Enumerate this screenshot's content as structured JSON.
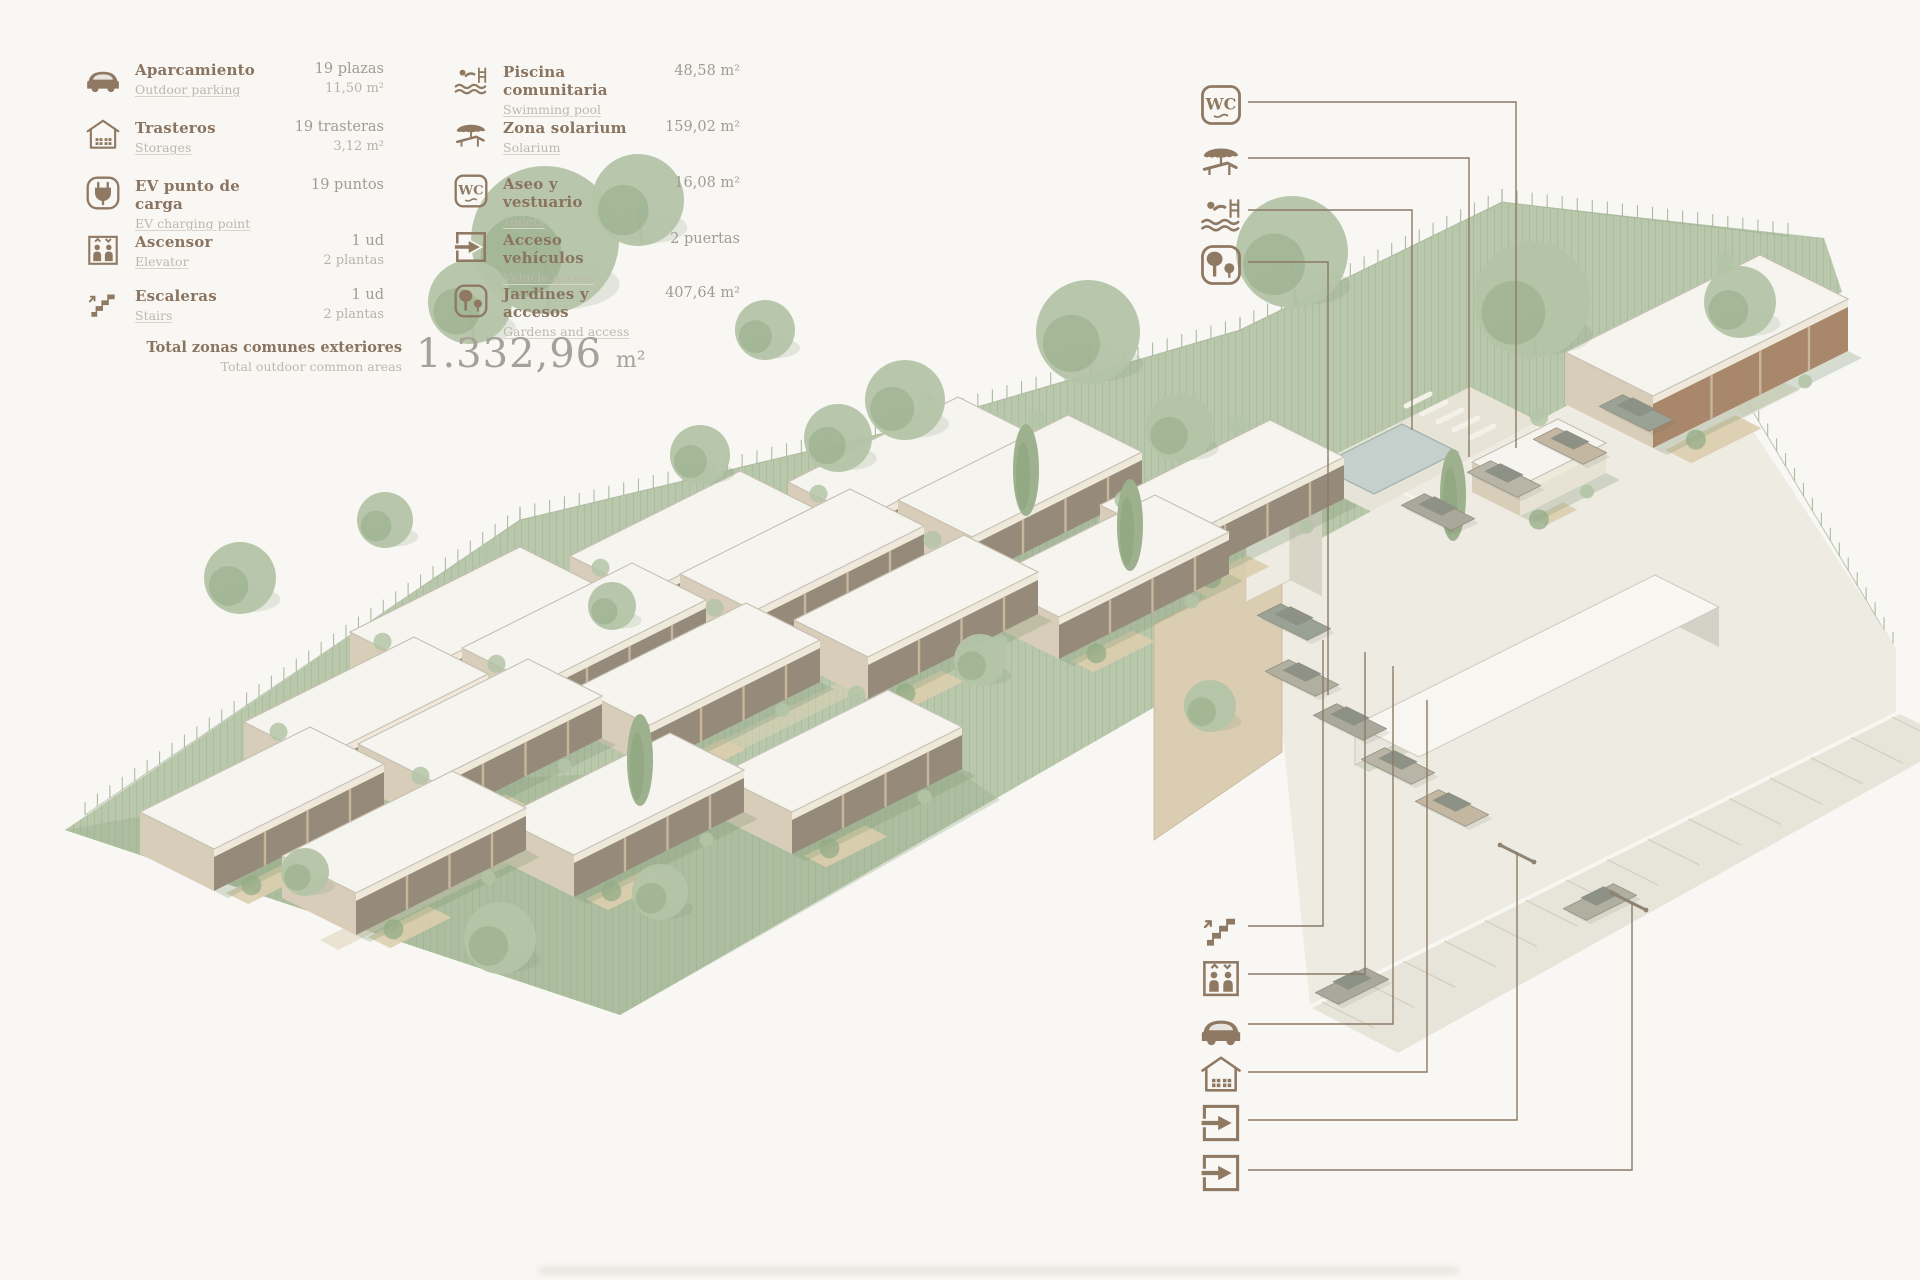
{
  "colors": {
    "bg": "#f8f7f3",
    "ink": "#8f7963",
    "label_es": "#8a7460",
    "label_en": "#bdb8ae",
    "value1": "#a09c93",
    "value2": "#b7b3aa",
    "total_num": "#a5a098",
    "leader": "#8a7a66",
    "green_base": "#b9c8ab",
    "green_dark": "#93ab87",
    "hatch": "#93a989",
    "fence": "#9fb194",
    "roof": "#f6f4ee",
    "roof_stroke": "#c6c1b4",
    "fascia": "#efe9dc",
    "glass": "#968b7a",
    "frame": "#c8b69c",
    "end_wall": "#d8cdb9",
    "terrace": "#dbceae",
    "shadow": "#7e9674",
    "deck": "#e7e3d6",
    "pool": "#c5cfcb",
    "pool_edge": "#9fb0ab",
    "wall_tan": "#dbcdb2",
    "parking": "#edebe2",
    "road": "#e7e4d9",
    "road_hatch": "#d2cec0",
    "stall": "#fafaf4",
    "storage_front": "#e9e6dd",
    "storage_side": "#d4d1c6",
    "tree_light": "#b4c4a6",
    "tree_dark": "#93ab87",
    "trunk": "#8c8a76",
    "community_front": "#a8876b",
    "car_colors": [
      "#a9a89a",
      "#b8b5a6",
      "#c3b7a2",
      "#9aa195",
      "#b1afa0"
    ],
    "gate": "#8f8472"
  },
  "legend": {
    "columns": [
      {
        "x": 84,
        "width": 300,
        "row_tops": [
          58,
          116,
          174,
          230,
          284
        ],
        "items": [
          {
            "icon": "car",
            "label_es": "Aparcamiento",
            "label_en": "Outdoor parking",
            "values": [
              "19 plazas",
              "11,50 m²"
            ]
          },
          {
            "icon": "storage",
            "label_es": "Trasteros",
            "label_en": "Storages",
            "values": [
              "19 trasteras",
              "3,12 m²"
            ]
          },
          {
            "icon": "ev",
            "label_es": "EV punto de carga",
            "label_en": "EV charging point",
            "values": [
              "19 puntos"
            ]
          },
          {
            "icon": "elevator",
            "label_es": "Ascensor",
            "label_en": "Elevator",
            "values": [
              "1 ud",
              "2 plantas"
            ]
          },
          {
            "icon": "stairs",
            "label_es": "Escaleras",
            "label_en": "Stairs",
            "values": [
              "1 ud",
              "2 plantas"
            ]
          }
        ]
      },
      {
        "x": 452,
        "width": 288,
        "row_tops": [
          60,
          116,
          172,
          228,
          282
        ],
        "items": [
          {
            "icon": "pool",
            "label_es": "Piscina comunitaria",
            "label_en": "Swimming pool",
            "values": [
              "48,58 m²"
            ]
          },
          {
            "icon": "solarium",
            "label_es": "Zona solarium",
            "label_en": "Solarium",
            "values": [
              "159,02 m²"
            ]
          },
          {
            "icon": "wc",
            "label_es": "Aseo y vestuario",
            "label_en": "Toilets",
            "values": [
              "16,08 m²"
            ]
          },
          {
            "icon": "vehicle-access",
            "label_es": "Acceso vehículos",
            "label_en": "Vehicle access",
            "values": [
              "2 puertas"
            ]
          },
          {
            "icon": "gardens",
            "label_es": "Jardines y accesos",
            "label_en": "Gardens and access",
            "values": [
              "407,64 m²"
            ]
          }
        ]
      }
    ],
    "total": {
      "label_es": "Total zonas comunes exteriores",
      "label_en": "Total outdoor common areas",
      "value": "1.332,96",
      "unit": "m²"
    }
  },
  "callouts": {
    "icon_x": 1198,
    "top": [
      {
        "icon": "wc",
        "icon_y": 82,
        "line": [
          [
            1248,
            102
          ],
          [
            1516,
            102
          ],
          [
            1516,
            448
          ]
        ]
      },
      {
        "icon": "solarium",
        "icon_y": 138,
        "line": [
          [
            1248,
            158
          ],
          [
            1469,
            158
          ],
          [
            1469,
            457
          ]
        ]
      },
      {
        "icon": "pool",
        "icon_y": 190,
        "line": [
          [
            1248,
            210
          ],
          [
            1412,
            210
          ],
          [
            1412,
            430
          ]
        ]
      },
      {
        "icon": "gardens",
        "icon_y": 242,
        "line": [
          [
            1248,
            262
          ],
          [
            1328,
            262
          ],
          [
            1328,
            695
          ]
        ]
      }
    ],
    "bottom": [
      {
        "icon": "stairs",
        "icon_y": 906,
        "line": [
          [
            1248,
            926
          ],
          [
            1323,
            926
          ],
          [
            1323,
            640
          ]
        ]
      },
      {
        "icon": "elevator",
        "icon_y": 954,
        "line": [
          [
            1248,
            974
          ],
          [
            1365,
            974
          ],
          [
            1365,
            652
          ]
        ]
      },
      {
        "icon": "car",
        "icon_y": 1004,
        "line": [
          [
            1248,
            1024
          ],
          [
            1393,
            1024
          ],
          [
            1393,
            666
          ]
        ]
      },
      {
        "icon": "storage",
        "icon_y": 1052,
        "line": [
          [
            1248,
            1072
          ],
          [
            1427,
            1072
          ],
          [
            1427,
            700
          ]
        ]
      },
      {
        "icon": "vehicle-access",
        "icon_y": 1100,
        "line": [
          [
            1248,
            1120
          ],
          [
            1517,
            1120
          ],
          [
            1517,
            852
          ]
        ]
      },
      {
        "icon": "vehicle-access",
        "icon_y": 1150,
        "line": [
          [
            1248,
            1170
          ],
          [
            1632,
            1170
          ],
          [
            1632,
            902
          ]
        ]
      }
    ]
  },
  "site": {
    "parcel": [
      [
        65,
        830
      ],
      [
        520,
        520
      ],
      [
        905,
        428
      ],
      [
        1240,
        330
      ],
      [
        1502,
        202
      ],
      [
        1824,
        238
      ],
      [
        1842,
        292
      ],
      [
        1272,
        574
      ],
      [
        1160,
        704
      ],
      [
        620,
        1015
      ]
    ],
    "parcel_shade": [
      [
        65,
        830
      ],
      [
        620,
        1015
      ],
      [
        1000,
        800
      ],
      [
        940,
        758
      ],
      [
        300,
        788
      ]
    ],
    "row_strips": [
      [
        [
          190,
          846
        ],
        [
          880,
          506
        ],
        [
          900,
          516
        ],
        [
          210,
          856
        ]
      ],
      [
        [
          320,
          940
        ],
        [
          860,
          672
        ],
        [
          878,
          682
        ],
        [
          338,
          950
        ]
      ],
      [
        [
          1178,
          648
        ],
        [
          1556,
          458
        ],
        [
          1596,
          478
        ],
        [
          1218,
          668
        ]
      ]
    ],
    "fences": [
      {
        "pts": [
          [
            85,
            815
          ],
          [
            520,
            520
          ],
          [
            905,
            428
          ],
          [
            1240,
            330
          ],
          [
            1502,
            202
          ],
          [
            1788,
            236
          ]
        ],
        "step": 15
      },
      {
        "pts": [
          [
            1705,
            332
          ],
          [
            1893,
            645
          ]
        ],
        "step": 17
      }
    ],
    "deck": [
      [
        1296,
        474
      ],
      [
        1470,
        387
      ],
      [
        1562,
        433
      ],
      [
        1388,
        520
      ]
    ],
    "pool": [
      [
        1318,
        466
      ],
      [
        1402,
        424
      ],
      [
        1458,
        452
      ],
      [
        1374,
        494
      ]
    ],
    "loungers": {
      "base": [
        1406,
        406
      ],
      "step": [
        16,
        8
      ],
      "len": [
        24,
        -12
      ],
      "n": 5
    },
    "forecourt": [
      [
        1560,
        450
      ],
      [
        1740,
        360
      ],
      [
        1800,
        390
      ],
      [
        1620,
        480
      ]
    ],
    "parking": [
      [
        1266,
        568
      ],
      [
        1692,
        338
      ],
      [
        1896,
        648
      ],
      [
        1896,
        712
      ],
      [
        1310,
        1005
      ]
    ],
    "road": [
      [
        1312,
        1008
      ],
      [
        1900,
        714
      ],
      [
        1920,
        724
      ],
      [
        1920,
        762
      ],
      [
        1398,
        1053
      ]
    ],
    "road_hatch": {
      "a": [
        1322,
        1002
      ],
      "b": [
        1892,
        717
      ],
      "n": 14,
      "len": [
        52,
        26
      ]
    },
    "stalls": {
      "base": [
        1404,
        493
      ],
      "step": [
        66,
        -33
      ],
      "len": [
        54,
        27
      ],
      "n": 5
    },
    "storage": {
      "o": [
        1355,
        765
      ],
      "w": [
        300,
        -150
      ],
      "u": [
        64,
        32
      ],
      "h": 40
    },
    "wall": [
      [
        1154,
        624
      ],
      [
        1262,
        568
      ],
      [
        1282,
        578
      ],
      [
        1282,
        752
      ],
      [
        1154,
        840
      ]
    ],
    "shaft": {
      "front": [
        [
          1246,
          470
        ],
        [
          1290,
          448
        ],
        [
          1290,
          580
        ],
        [
          1246,
          602
        ]
      ],
      "side": [
        [
          1290,
          448
        ],
        [
          1322,
          464
        ],
        [
          1322,
          596
        ],
        [
          1290,
          580
        ]
      ],
      "roof": [
        [
          1246,
          470
        ],
        [
          1290,
          448
        ],
        [
          1322,
          464
        ],
        [
          1278,
          486
        ]
      ]
    },
    "house_dims": {
      "w": [
        170,
        -85
      ],
      "u": [
        74,
        37
      ],
      "h": 42
    },
    "houses": [
      [
        350,
        632
      ],
      [
        570,
        556
      ],
      [
        788,
        482
      ],
      [
        244,
        722
      ],
      [
        462,
        648
      ],
      [
        680,
        574
      ],
      [
        898,
        500
      ],
      [
        140,
        812
      ],
      [
        358,
        744
      ],
      [
        576,
        688
      ],
      [
        794,
        620
      ],
      [
        282,
        856
      ],
      [
        500,
        818
      ],
      [
        718,
        775
      ],
      [
        985,
        580
      ],
      [
        1100,
        505
      ]
    ],
    "community": {
      "o": [
        1565,
        352
      ],
      "w": [
        195,
        -97
      ],
      "u": [
        88,
        44
      ],
      "h": 52
    },
    "wc_hut": {
      "o": [
        1472,
        462
      ],
      "w": [
        86,
        -43
      ],
      "u": [
        48,
        24
      ],
      "h": 30
    },
    "trees": [
      [
        545,
        240,
        74
      ],
      [
        638,
        200,
        46
      ],
      [
        470,
        302,
        42
      ],
      [
        905,
        400,
        40
      ],
      [
        1088,
        332,
        52
      ],
      [
        1292,
        252,
        56
      ],
      [
        1532,
        300,
        58
      ],
      [
        240,
        578,
        36
      ],
      [
        700,
        455,
        30
      ],
      [
        1180,
        428,
        34
      ],
      [
        838,
        438,
        34
      ],
      [
        1740,
        302,
        36
      ],
      [
        500,
        938,
        36
      ],
      [
        660,
        892,
        28
      ],
      [
        305,
        872,
        24
      ],
      [
        1210,
        706,
        26
      ],
      [
        612,
        606,
        24
      ],
      [
        980,
        660,
        26
      ],
      [
        385,
        520,
        28
      ],
      [
        765,
        330,
        30
      ]
    ],
    "cypresses": [
      [
        1453,
        495
      ],
      [
        1130,
        525
      ],
      [
        640,
        760
      ],
      [
        1026,
        470
      ]
    ],
    "cars": [
      {
        "c": [
          1438,
          512
        ],
        "dir": "u"
      },
      {
        "c": [
          1504,
          479
        ],
        "dir": "u"
      },
      {
        "c": [
          1570,
          446
        ],
        "dir": "u"
      },
      {
        "c": [
          1636,
          413
        ],
        "dir": "u"
      },
      {
        "c": [
          1302,
          678
        ],
        "dir": "u"
      },
      {
        "c": [
          1350,
          722
        ],
        "dir": "u"
      },
      {
        "c": [
          1398,
          766
        ],
        "dir": "u"
      },
      {
        "c": [
          1452,
          808
        ],
        "dir": "u"
      },
      {
        "c": [
          1294,
          622
        ],
        "dir": "u"
      },
      {
        "c": [
          1600,
          902
        ],
        "dir": "w"
      },
      {
        "c": [
          1352,
          986
        ],
        "dir": "w"
      }
    ],
    "gates": [
      [
        1500,
        845
      ],
      [
        1612,
        893
      ]
    ]
  }
}
